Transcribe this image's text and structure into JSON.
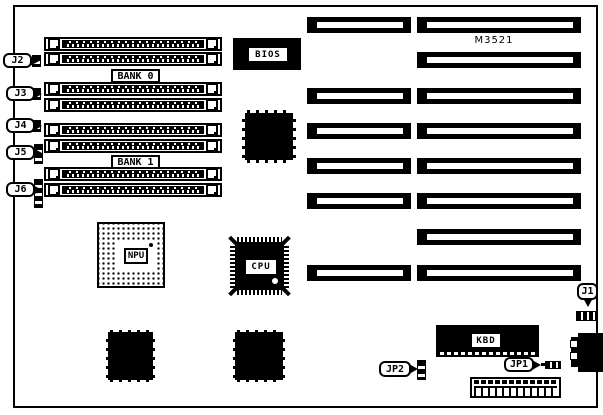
{
  "board": {
    "model": "M3521",
    "memory": {
      "bank0_label": "BANK 0",
      "bank1_label": "BANK 1",
      "callouts": [
        {
          "id": "J2"
        },
        {
          "id": "J3"
        },
        {
          "id": "J4"
        },
        {
          "id": "J5"
        },
        {
          "id": "J6"
        }
      ]
    },
    "chips": {
      "bios_label": "BIOS",
      "npu_label": "NPU",
      "cpu_label": "CPU",
      "kbd_label": "KBD"
    },
    "connectors": {
      "j1_label": "J1",
      "jp1_label": "JP1",
      "jp2_label": "JP2"
    }
  }
}
